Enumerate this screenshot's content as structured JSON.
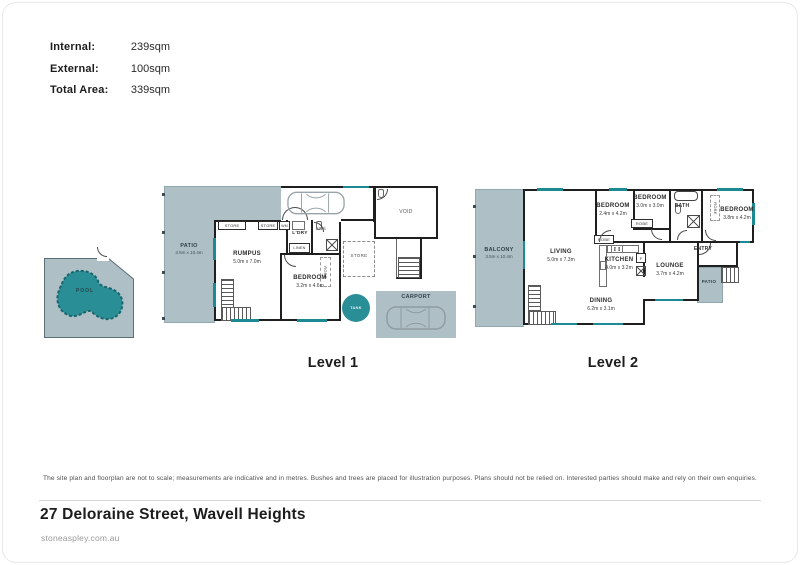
{
  "area_summary": {
    "rows": [
      {
        "label": "Internal:",
        "value": "239sqm"
      },
      {
        "label": "External:",
        "value": "100sqm"
      },
      {
        "label": "Total Area:",
        "value": "339sqm"
      }
    ]
  },
  "plans": {
    "level1": {
      "label": "Level 1",
      "rooms": {
        "patio": {
          "name": "PATIO",
          "dims": "3.5m x 10.4m"
        },
        "pool": {
          "name": "POOL"
        },
        "tank": {
          "name": "TANK"
        },
        "rumpus": {
          "name": "RUMPUS",
          "dims": "5.0m x 7.0m"
        },
        "bedroom": {
          "name": "BEDROOM",
          "dims": "3.2m x 4.6m"
        },
        "laundry": {
          "name": "L'DRY"
        },
        "linen": {
          "name": "LINEN"
        },
        "ensuite": {
          "name": "ENS"
        },
        "wm": {
          "name": "WM"
        },
        "store_a": {
          "name": "STORE"
        },
        "store_b": {
          "name": "STORE"
        },
        "store_c": {
          "name": "STORE"
        },
        "robe": {
          "name": "ROBE"
        },
        "void": {
          "name": "VOID"
        },
        "carport": {
          "name": "CARPORT"
        }
      }
    },
    "level2": {
      "label": "Level 2",
      "rooms": {
        "balcony": {
          "name": "BALCONY",
          "dims": "3.5m x 10.4m"
        },
        "living": {
          "name": "LIVING",
          "dims": "5.0m x 7.3m"
        },
        "dining": {
          "name": "DINING",
          "dims": "6.2m x 3.1m"
        },
        "kitchen": {
          "name": "KITCHEN",
          "dims": "4.0m x 3.2m"
        },
        "lounge": {
          "name": "LOUNGE",
          "dims": "3.7m x 4.2m"
        },
        "bedroom1": {
          "name": "BEDROOM",
          "dims": "2.4m x 4.2m"
        },
        "bedroom2": {
          "name": "BEDROOM",
          "dims": "3.0m x 3.0m"
        },
        "bedroom3": {
          "name": "BEDROOM",
          "dims": "3.8m x 4.2m"
        },
        "bath": {
          "name": "BATH"
        },
        "entry": {
          "name": "ENTRY"
        },
        "patio": {
          "name": "PATIO"
        },
        "robe1": {
          "name": "ROBE"
        },
        "robe2": {
          "name": "ROBE"
        },
        "robe3": {
          "name": "ROBE"
        },
        "fridge": {
          "name": "F"
        }
      }
    }
  },
  "footer": {
    "disclaimer": "The site plan and floorplan are not to scale; measurements are indicative and in metres. Bushes and trees are placed for illustration purposes. Plans should not be relied on. Interested parties should make and rely on their own enquiries.",
    "address": "27 Deloraine Street, Wavell Heights",
    "website": "stoneaspley.com.au"
  },
  "colors": {
    "external_area": "#aec0c6",
    "water_teal": "#2a8e96",
    "window_accent": "#1b8a93",
    "wall": "#1f1f1f"
  }
}
